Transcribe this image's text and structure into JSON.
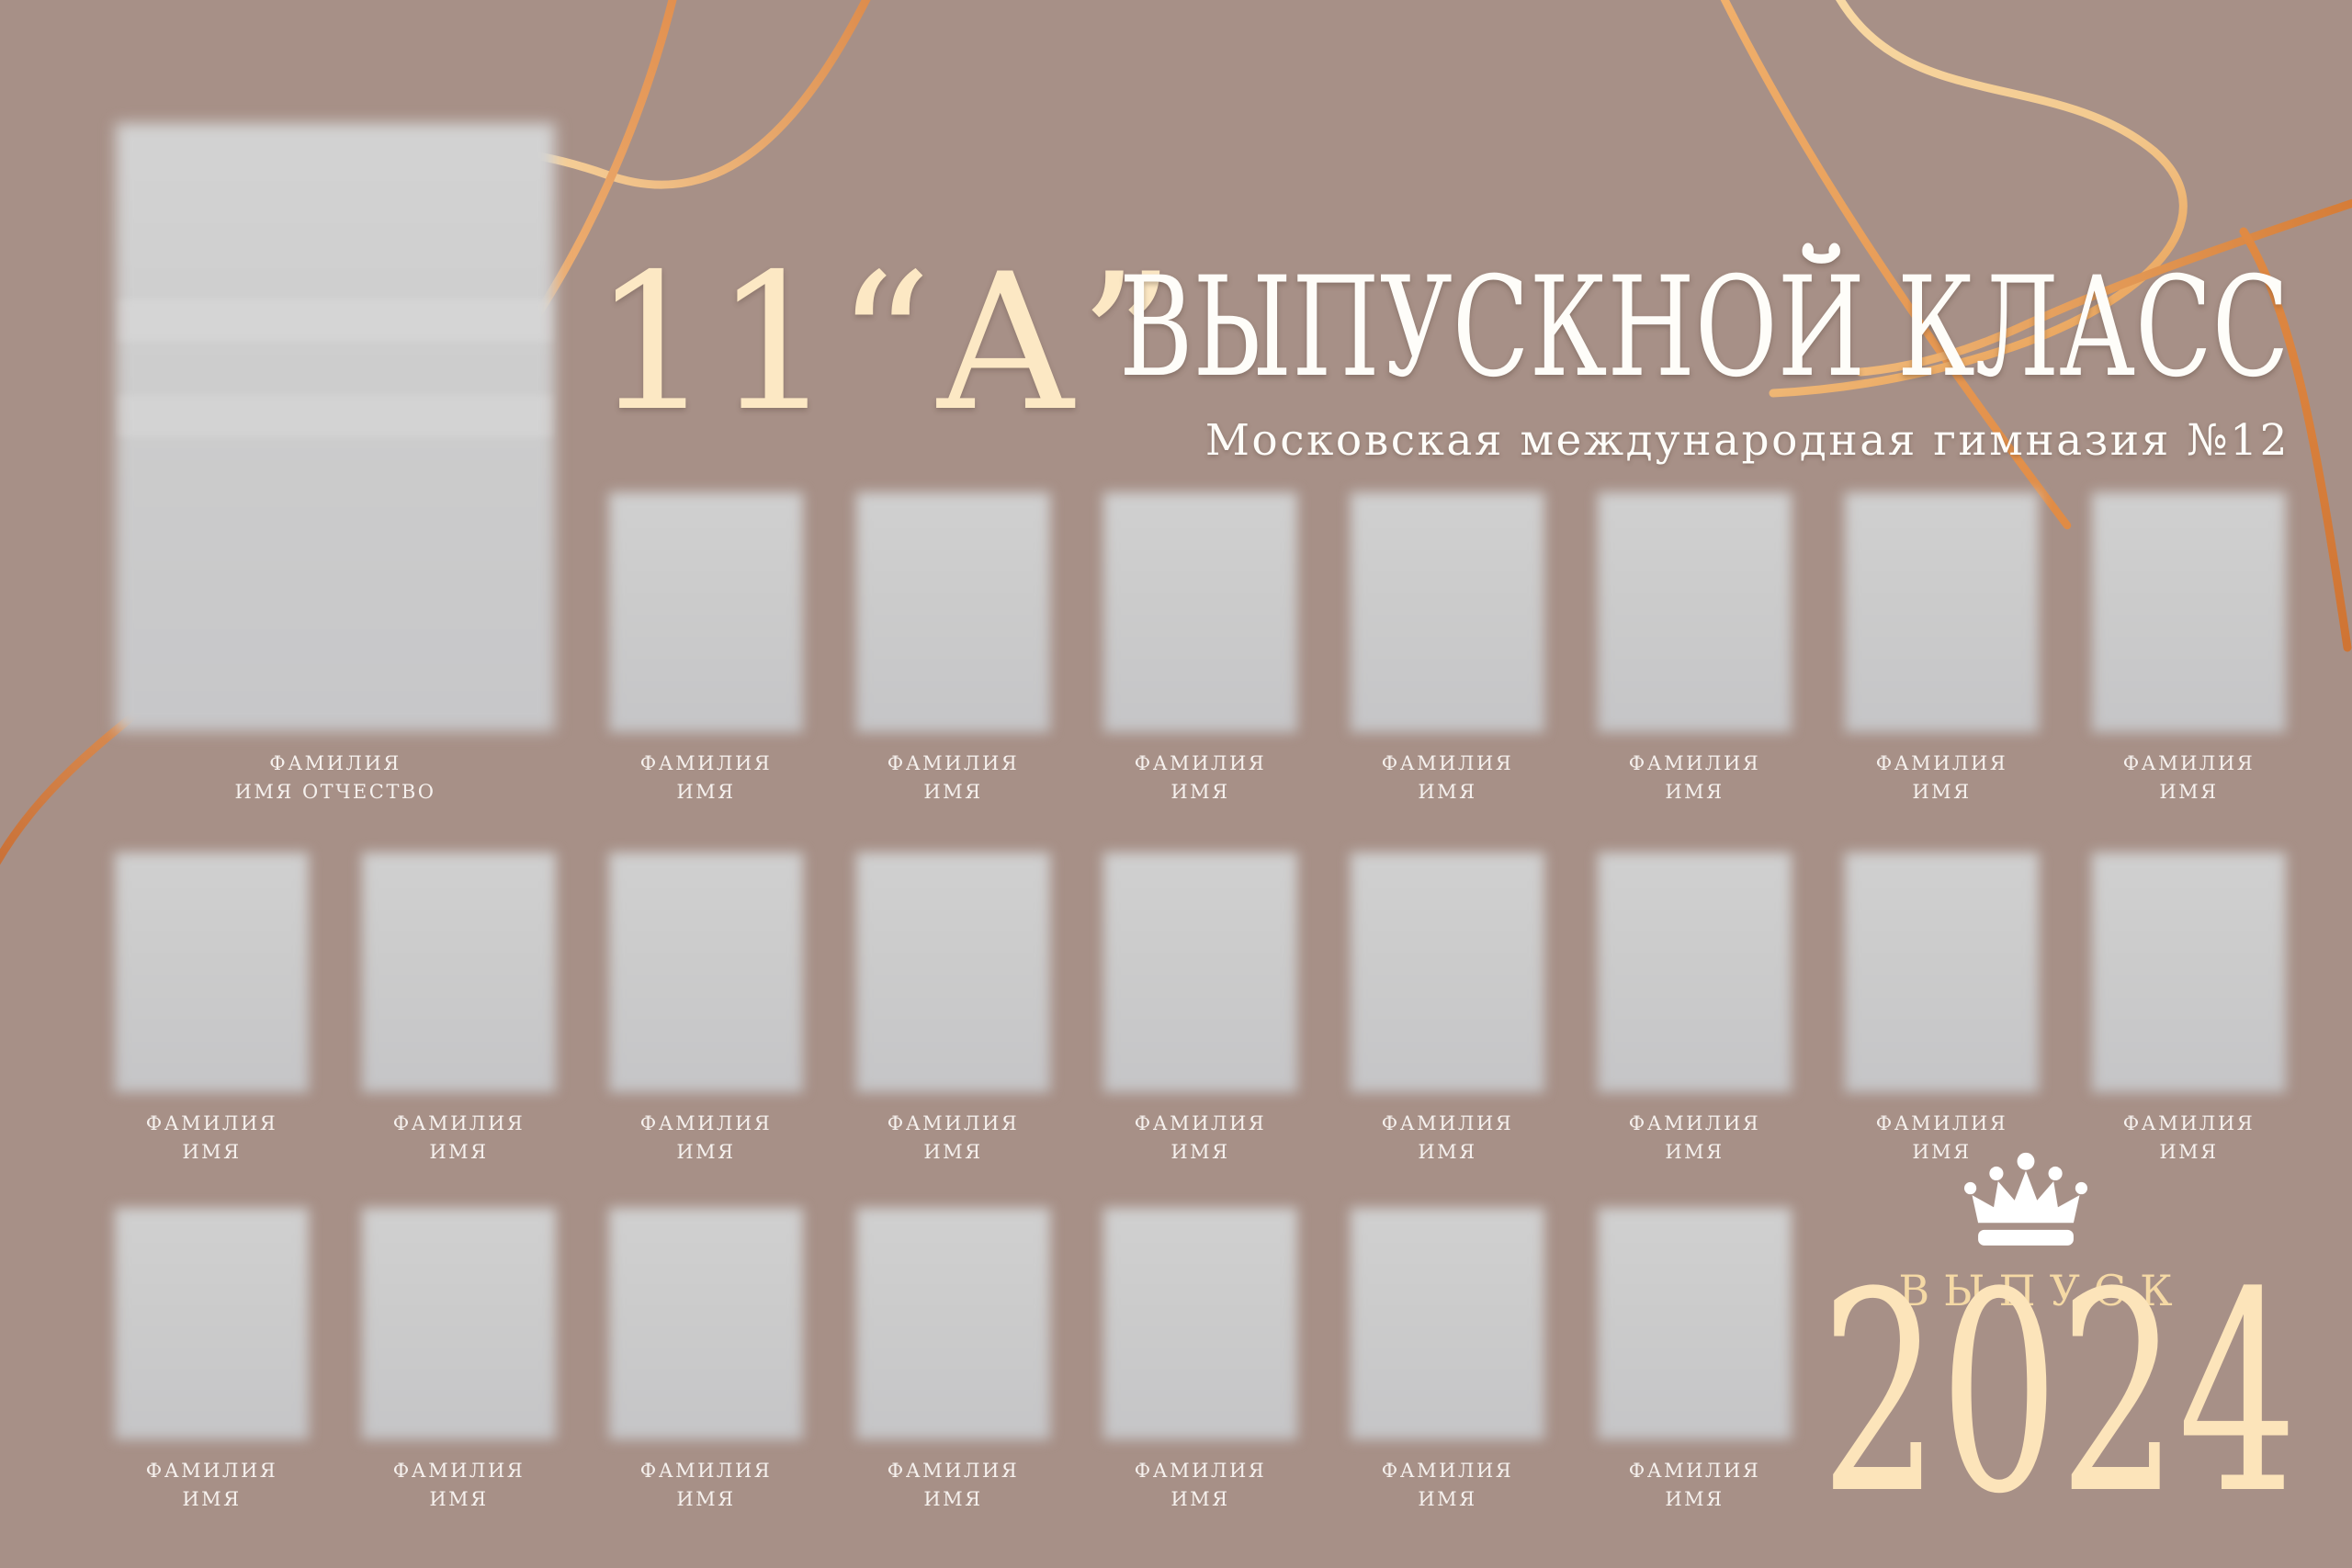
{
  "poster": {
    "type": "graduation-class-photo-board"
  },
  "header": {
    "class_label": "11“А”",
    "title": "ВЫПУСКНОЙ КЛАСС",
    "subtitle": "Московская международная гимназия №12"
  },
  "featured": {
    "caption_line1": "ФАМИЛИЯ",
    "caption_line2": "ИМЯ ОТЧЕСТВО"
  },
  "students": {
    "caption_line1": "ФАМИЛИЯ",
    "caption_line2": "ИМЯ"
  },
  "grid": {
    "rows": [
      {
        "id": "top",
        "count": 7
      },
      {
        "id": "middle",
        "count": 9
      },
      {
        "id": "bottom",
        "count": 7
      }
    ]
  },
  "footer": {
    "issue_label": "ВЫПУСК",
    "year": "2024"
  },
  "icons": {
    "crown": "crown-icon"
  },
  "colors": {
    "background": "#a79087",
    "cream": "#fce8c4",
    "title_white": "#fefdf9",
    "caption_white": "#f6f1ee",
    "gold": "#f5d9a5",
    "year_cream": "#fce4ba",
    "placeholder_gray": "#cbcbcb",
    "line_copper": "#cd7b3e",
    "line_gold_light": "#f8d6a0",
    "crown_white": "#ffffff"
  }
}
